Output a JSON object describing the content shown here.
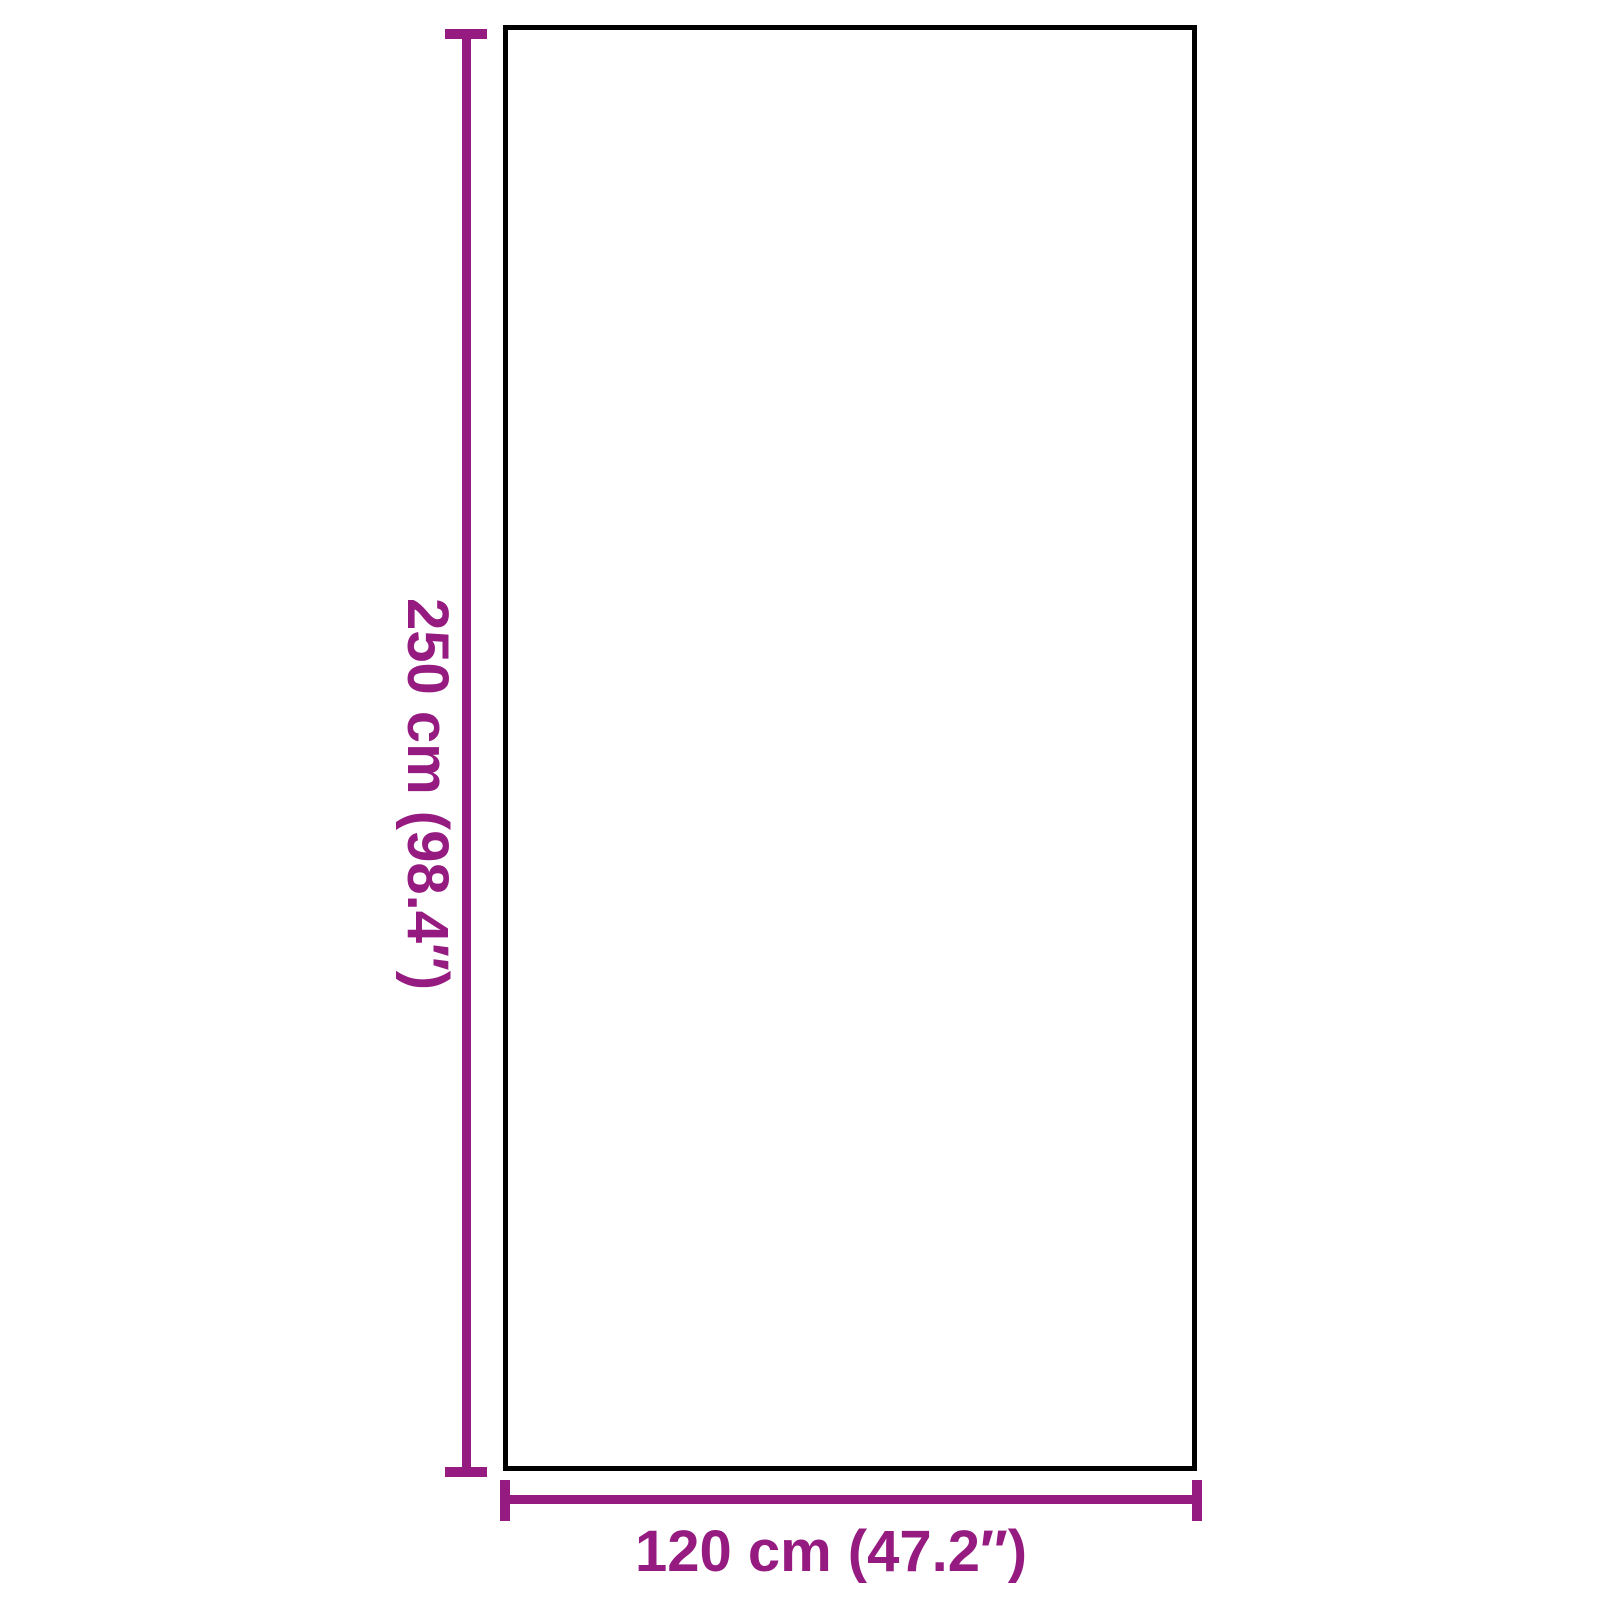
{
  "colors": {
    "dimension": "#951b81",
    "outline": "#000000",
    "background": "#ffffff"
  },
  "diagram": {
    "type": "product-dimension-diagram",
    "shape": "rectangle",
    "height": {
      "label": "250 cm (98.4″)",
      "value_cm": 250,
      "value_inch": 98.4
    },
    "width": {
      "label": "120 cm (47.2″)",
      "value_cm": 120,
      "value_inch": 47.2
    }
  }
}
